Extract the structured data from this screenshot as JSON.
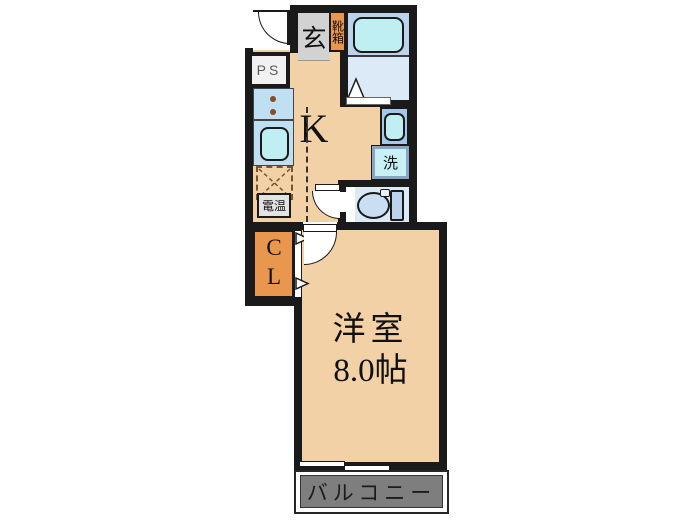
{
  "labels": {
    "entrance": "玄",
    "shoe_box": "靴箱",
    "pipe_space": "PS",
    "kitchen": "K",
    "water_heater": "電温",
    "washer": "洗",
    "closet": "CL",
    "room_name": "洋室",
    "room_size": "8.0帖",
    "balcony": "バルコニー"
  },
  "colors": {
    "wall": "#1a1a1a",
    "floor_tan": "#F2D1A7",
    "accent_orange": "#E9964F",
    "tile_gray": "#D2D2D2",
    "bath_band": "#BCD3EB",
    "bath_floor": "#DCEAF7",
    "fixture_cyan": "#BFEFF3",
    "counter_blue": "#BFE0F2",
    "basin_blue": "#A5C8E8",
    "toilet_blue": "#C9DDF3",
    "washer_frame": "#8AA4C4",
    "balcony_gray": "#7E7E7E",
    "dash_brown": "#7A5230"
  }
}
